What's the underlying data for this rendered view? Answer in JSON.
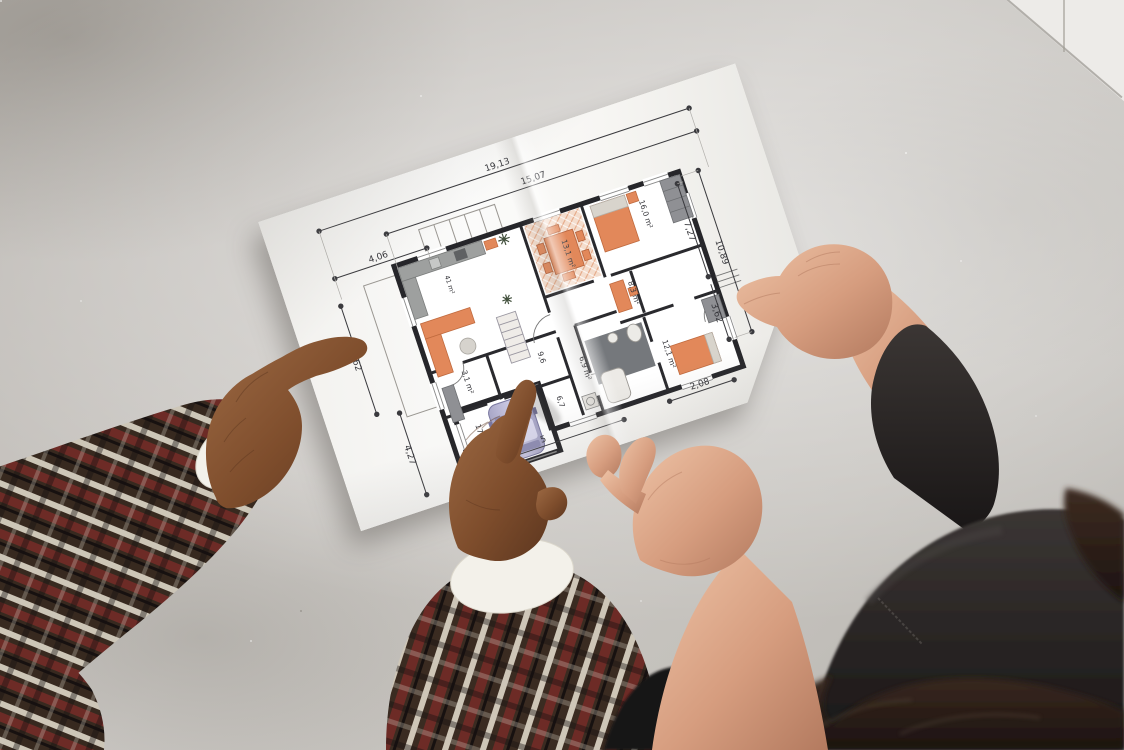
{
  "scene": {
    "palette": {
      "floor_concrete": "#c4c1bc",
      "wall_white": "#edebe8",
      "paper": "#f8f7f5",
      "plan_wall": "#26262a",
      "furniture_orange": "#e2885a",
      "hatch_pink": "#f4ddcd",
      "counter_gray": "#9ea09f",
      "car_lavender": "#c9c7e2",
      "skin_dark": "#7e4d2c",
      "skin_light": "#d69d7f",
      "plaid_base": "#37291f",
      "plaid_red": "#6d2b26",
      "plaid_white": "#ded7c8",
      "shirt_white": "#f3f1ea",
      "leather_black": "#1f1c1b",
      "hair_brown": "#2e211b"
    }
  },
  "floor_plan": {
    "dimensions": {
      "top_outer": "19,13",
      "top_inner": "15,07",
      "top_left": "4,06",
      "left_upper": "6,62",
      "left_lower": "4,27",
      "right_inner": "7,27",
      "right_outer": "10,89",
      "right_lower": "3,62",
      "bottom_right": "2,08",
      "bottom_partial": "5"
    },
    "room_areas": {
      "dining": "13,1 m²",
      "top_right_bedroom": "16,0 m²",
      "center_right_small": "8,3 m²",
      "lower_right_bedroom": "12,1 m²",
      "bathroom": "6,9 m²",
      "hallway": "9,6",
      "wc": "3,1 m²",
      "lower_left_room": "3,9 m²",
      "lower_center_small": "6,7",
      "garage": "17,6 m²",
      "living_area": "41 m²"
    }
  }
}
